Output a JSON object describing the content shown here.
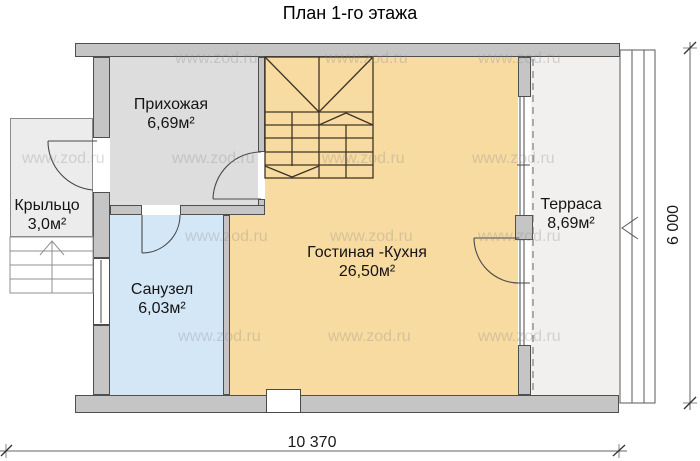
{
  "title": "План 1-го этажа",
  "watermark": {
    "text": "www.zod.ru"
  },
  "rooms": [
    {
      "id": "hallway",
      "name": "Прихожая",
      "area": "6,69м²"
    },
    {
      "id": "porch",
      "name": "Крыльцо",
      "area": "3,0м²"
    },
    {
      "id": "bathroom",
      "name": "Санузел",
      "area": "6,03м²"
    },
    {
      "id": "living_kitchen",
      "name": "Гостиная -Кухня",
      "area": "26,50м²"
    },
    {
      "id": "terrace",
      "name": "Терраса",
      "area": "8,69м²"
    }
  ],
  "dimensions": {
    "width_label": "10 370",
    "height_label": "6 000"
  },
  "colors": {
    "wall_fill": "#c5c5c5",
    "wall_outline": "#4f4f4f",
    "living_kitchen_fill": "#f7dba0",
    "bathroom_fill": "#d3e7f7",
    "hallway_fill": "#dddddd",
    "porch_fill": "#ececec",
    "terrace_fill": "#f1f0ee",
    "stair_line": "#3f3526",
    "watermark_text": "#8a8a8a"
  }
}
